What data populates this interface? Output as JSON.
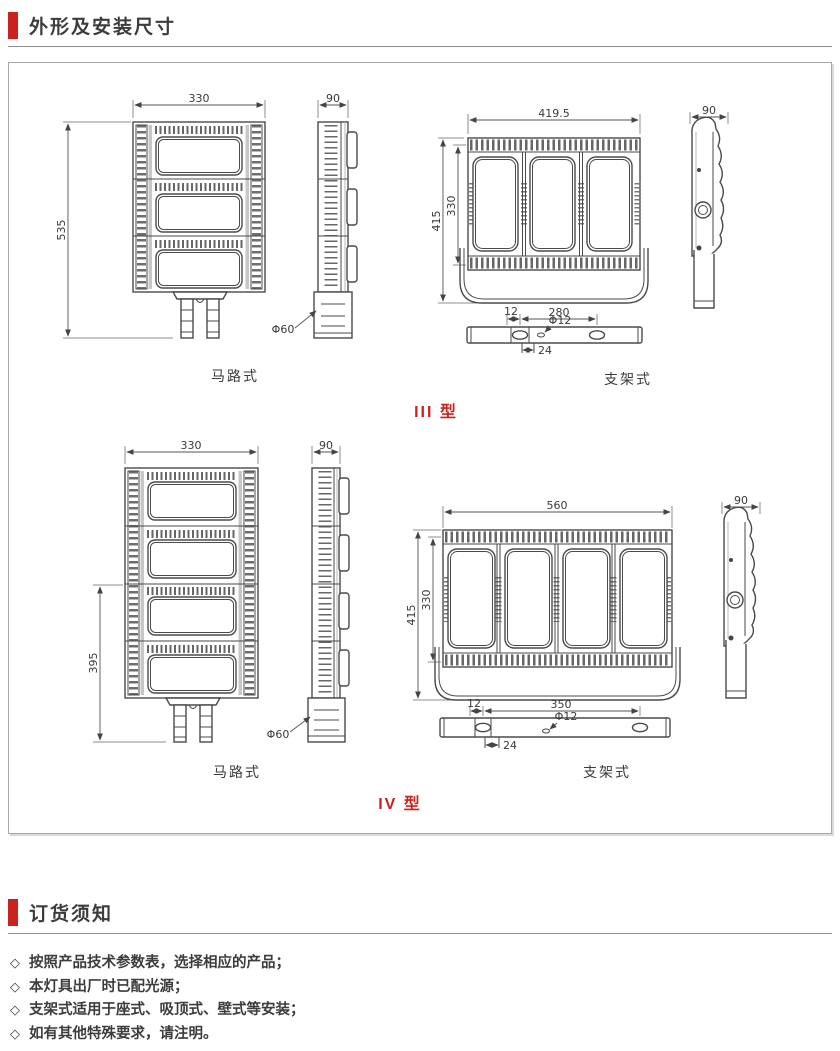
{
  "sections": {
    "dimensions_title": "外形及安装尺寸",
    "ordering_title": "订货须知"
  },
  "colors": {
    "accent_red": "#c9221f"
  },
  "type3": {
    "label": "III 型",
    "road": {
      "view_label": "马路式",
      "front_width": "330",
      "front_height": "535",
      "side_width": "90",
      "pole_diameter": "Φ60"
    },
    "bracket": {
      "view_label": "支架式",
      "front_width": "419.5",
      "total_height": "415",
      "body_height": "330",
      "side_width": "90",
      "mount": {
        "edge_offset": "12",
        "hole_span": "280",
        "hole_diameter": "Φ12",
        "slot_width": "24"
      }
    }
  },
  "type4": {
    "label": "IV 型",
    "road": {
      "view_label": "马路式",
      "front_width": "330",
      "front_height": "395",
      "side_width": "90",
      "pole_diameter": "Φ60"
    },
    "bracket": {
      "view_label": "支架式",
      "front_width": "560",
      "total_height": "415",
      "body_height": "330",
      "side_width": "90",
      "mount": {
        "edge_offset": "12",
        "hole_span": "350",
        "hole_diameter": "Φ12",
        "slot_width": "24"
      }
    }
  },
  "ordering_notes": {
    "bullet": "◇",
    "items": [
      "按照产品技术参数表，选择相应的产品；",
      "本灯具出厂时已配光源；",
      "支架式适用于座式、吸顶式、壁式等安装；",
      "如有其他特殊要求，请注明。"
    ]
  }
}
